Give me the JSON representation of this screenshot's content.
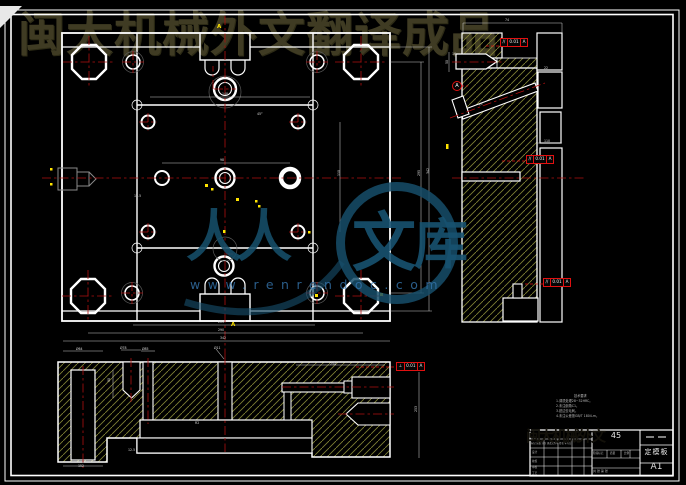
{
  "watermarks": {
    "top_text": "闽大机械外文翻译成品",
    "logo_left": "人人",
    "logo_char1": "文",
    "logo_char2": "库",
    "url": "www.renrendoc.com",
    "titleblock_blob": "闽大机械外文"
  },
  "section_marks": {
    "top": "A",
    "bottom": "A"
  },
  "datum": {
    "label": "A"
  },
  "tolerance_frames": [
    {
      "symbol": "//",
      "value": "0.01",
      "datum": "A"
    },
    {
      "symbol": "//",
      "value": "0.01",
      "datum": "A"
    },
    {
      "symbol": "//",
      "value": "0.01",
      "datum": "A"
    },
    {
      "symbol": "⊥",
      "value": "0.01",
      "datum": "A"
    }
  ],
  "notes": {
    "title": "技术要求",
    "line1": "1.调质处理28~32HRC。",
    "line2": "2.未注倒角C1。",
    "line3": "3.锐边去毛刺。",
    "line4": "4.未注公差按GB/T 1804-m。"
  },
  "title_block": {
    "material": "45",
    "part_name": "定模板",
    "sheet": "A1",
    "stage_label": "阶段标记",
    "mass_label": "质量",
    "scale_label": "比例",
    "sheet_count": "共 张 第 张",
    "header": "标记 处数 分区 更改文件号 签名 年月日",
    "row1": "设计",
    "row2": "校核",
    "row3": "审核",
    "row4": "工艺"
  },
  "dim_labels": [
    {
      "x": 222,
      "y": 92,
      "t": "148"
    },
    {
      "x": 220,
      "y": 158,
      "t": "98"
    },
    {
      "x": 257,
      "y": 112,
      "t": "45°"
    },
    {
      "x": 218,
      "y": 320,
      "t": "201"
    },
    {
      "x": 218,
      "y": 328,
      "t": "290"
    },
    {
      "x": 220,
      "y": 336,
      "t": "342"
    },
    {
      "x": 417,
      "y": 176,
      "t": "295",
      "r": -90
    },
    {
      "x": 426,
      "y": 174,
      "t": "342",
      "r": -90
    },
    {
      "x": 337,
      "y": 176,
      "t": "110",
      "r": -90
    },
    {
      "x": 505,
      "y": 18,
      "t": "74"
    },
    {
      "x": 445,
      "y": 64,
      "t": "50",
      "r": -90
    },
    {
      "x": 478,
      "y": 103,
      "t": "45°",
      "r": -20
    },
    {
      "x": 544,
      "y": 139,
      "t": "110"
    },
    {
      "x": 544,
      "y": 66,
      "t": "22"
    },
    {
      "x": 452,
      "y": 52,
      "t": "16"
    },
    {
      "x": 76,
      "y": 347,
      "t": "Ø64"
    },
    {
      "x": 120,
      "y": 346,
      "t": "Ø78"
    },
    {
      "x": 142,
      "y": 347,
      "t": "Ø85"
    },
    {
      "x": 214,
      "y": 346,
      "t": "Ø11"
    },
    {
      "x": 330,
      "y": 362,
      "t": "254"
    },
    {
      "x": 78,
      "y": 464,
      "t": "152"
    },
    {
      "x": 107,
      "y": 382,
      "t": "90",
      "r": -90
    },
    {
      "x": 414,
      "y": 412,
      "t": "253",
      "r": -90
    },
    {
      "x": 128,
      "y": 448,
      "t": "12.5"
    },
    {
      "x": 195,
      "y": 421,
      "t": "R2"
    },
    {
      "x": 134,
      "y": 194,
      "t": "12.5"
    }
  ]
}
